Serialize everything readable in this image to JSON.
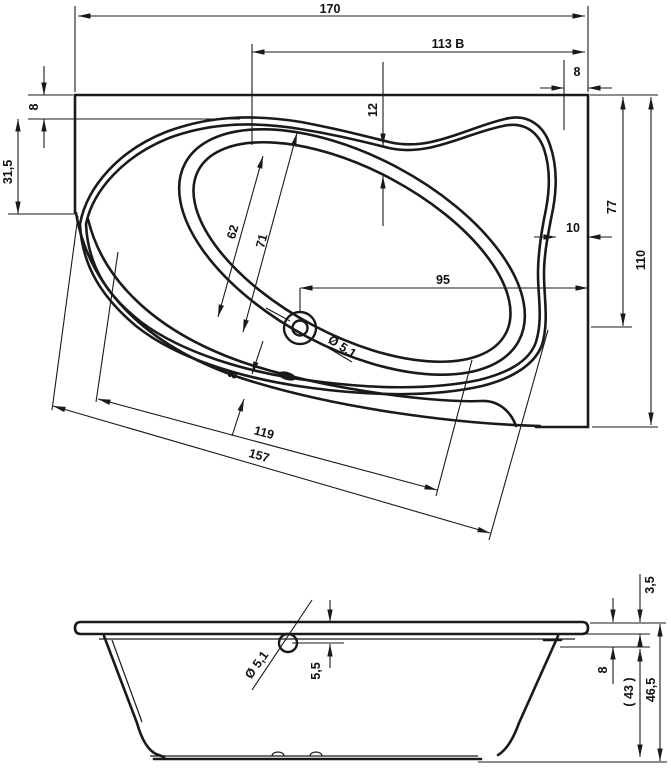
{
  "top_view": {
    "overall_width": "170",
    "width_b": "113 B",
    "rim_offset_right": "8",
    "rim_offset_left": "8",
    "left_edge_depth": "31,5",
    "rim_shelf_width": "12",
    "basin_width_inner": "62",
    "basin_width_outer": "71",
    "drain_to_right_edge": "95",
    "drain_diameter": "Ø 5,1",
    "rim_gap_right": "10",
    "drain_depth_from_top": "77",
    "overall_depth": "110",
    "rim_width_front": "8",
    "front_edge_inner": "119",
    "front_edge_outer": "157"
  },
  "side_view": {
    "rim_thickness": "3,5",
    "flange_height": "8",
    "inner_depth": "( 43 )",
    "total_height": "46,5",
    "overflow_offset": "5,5",
    "overflow_diameter": "Ø 5,1"
  },
  "colors": {
    "line": "#1a1a1a",
    "background": "#ffffff"
  }
}
